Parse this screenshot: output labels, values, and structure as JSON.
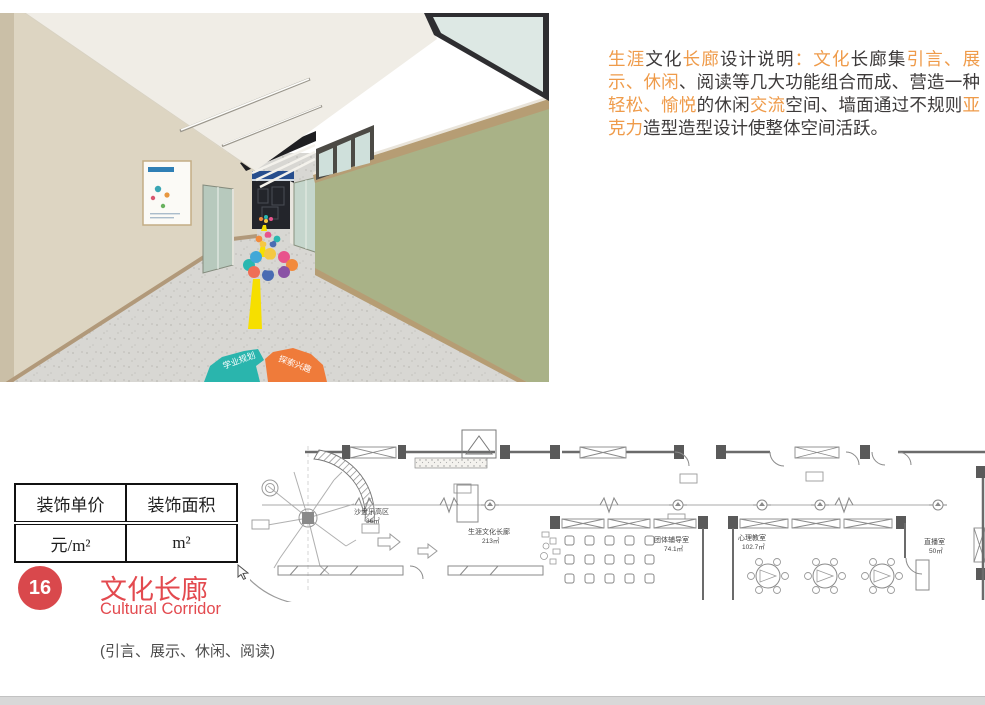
{
  "description": {
    "accent_color": "#ef9b4a",
    "text_color": "#3d3a3a",
    "segments": [
      {
        "text": "生涯",
        "tone": "accent"
      },
      {
        "text": "文化",
        "tone": "normal"
      },
      {
        "text": "长廊",
        "tone": "accent"
      },
      {
        "text": "设计说明",
        "tone": "normal"
      },
      {
        "text": "：文化",
        "tone": "accent"
      },
      {
        "text": "长廊集",
        "tone": "normal"
      },
      {
        "text": "引言、展示、休闲",
        "tone": "accent"
      },
      {
        "text": "、阅读等几大功能组合而成、营造一种",
        "tone": "normal"
      },
      {
        "text": "轻松、愉悦",
        "tone": "accent"
      },
      {
        "text": "的休闲",
        "tone": "normal"
      },
      {
        "text": "交流",
        "tone": "accent"
      },
      {
        "text": "空间、墙面通过不规则",
        "tone": "normal"
      },
      {
        "text": "亚克力",
        "tone": "accent"
      },
      {
        "text": "造型造型设计使整体空间活跃。",
        "tone": "normal"
      }
    ]
  },
  "price_table": {
    "columns": [
      {
        "header": "装饰单价",
        "value": "元/m²"
      },
      {
        "header": "装饰面积",
        "value": "m²"
      }
    ]
  },
  "section": {
    "number": "16",
    "title": "文化长廊",
    "subtitle": "Cultural Corridor",
    "note": "(引言、展示、休闲、阅读)",
    "badge_color": "#d9484c",
    "title_color": "#e34a4f"
  },
  "photo": {
    "floor_sign_left": "学业规划",
    "floor_sign_right": "探索兴趣",
    "wall_green": "#a9b287",
    "wall_beige": "#ddd5c2",
    "trim_tan": "#b69d74",
    "line_yellow": "#f6df00"
  },
  "floor_plan": {
    "labels": [
      {
        "name": "沙盘乐高区",
        "area": "36㎡"
      },
      {
        "name": "生涯文化长廊",
        "area": "213㎡"
      },
      {
        "name": "团体辅导室",
        "area": "74.1㎡"
      },
      {
        "name": "心理教室",
        "area": "102.7㎡"
      },
      {
        "name": "直播室",
        "area": "50㎡"
      }
    ]
  }
}
